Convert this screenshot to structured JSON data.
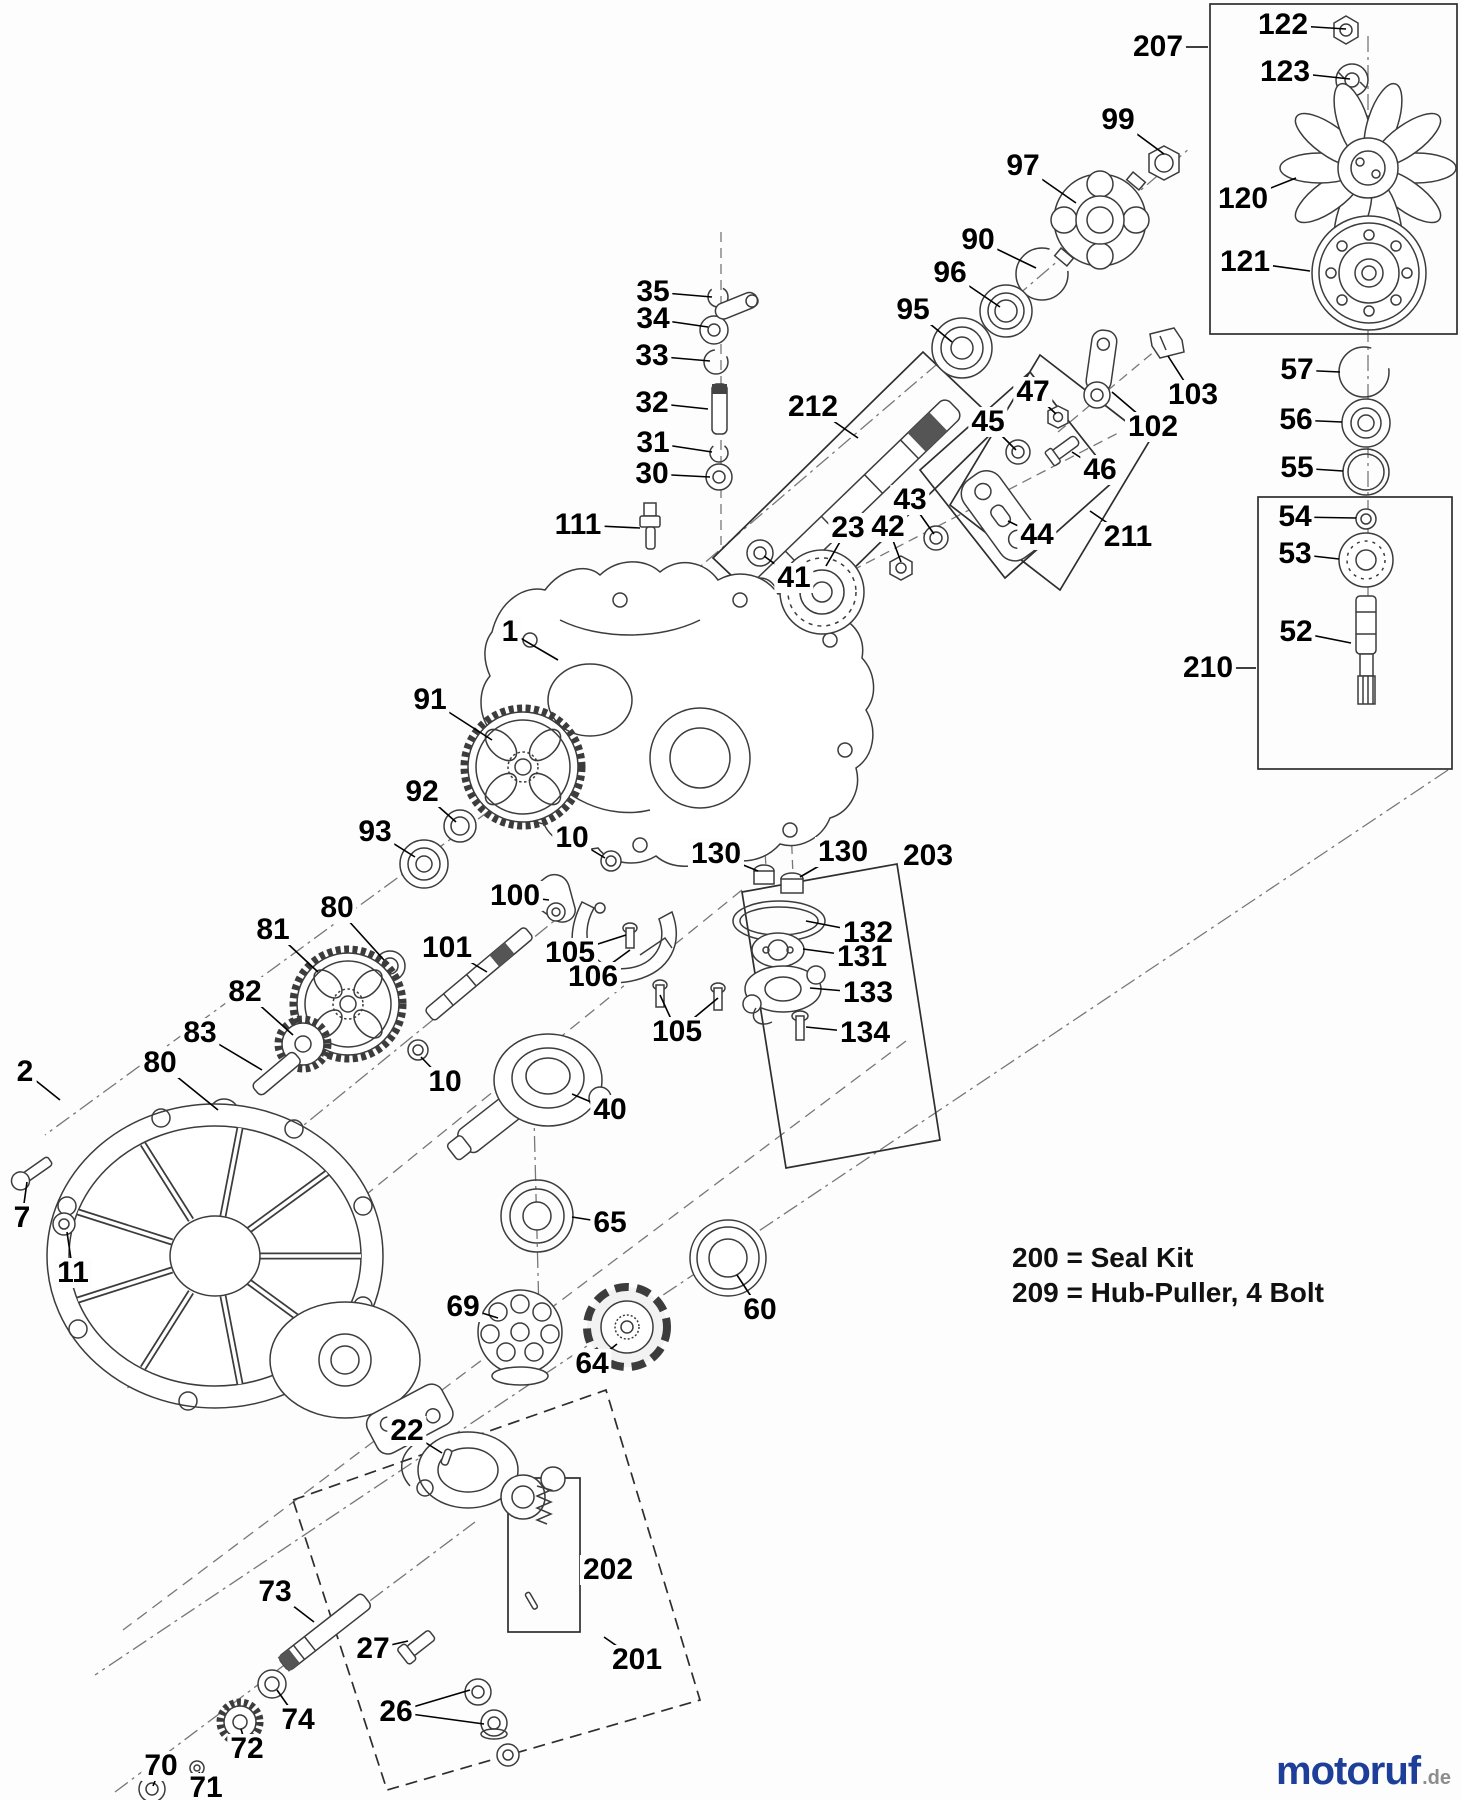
{
  "notes": {
    "line1": "200 = Seal Kit",
    "line2": "209 = Hub-Puller, 4 Bolt"
  },
  "watermark": {
    "brand": "motoruf",
    "tld": ".de",
    "brand_color": "#1e3f99",
    "tld_color": "#8d8d8d"
  },
  "diagram": {
    "title": "Transaxle exploded parts diagram",
    "line_color": "#3c3c3c",
    "label_color": "#000000",
    "callouts": [
      {
        "label": "122",
        "x": 1283,
        "y": 25,
        "targets": [
          [
            1346,
            29
          ]
        ]
      },
      {
        "label": "123",
        "x": 1285,
        "y": 72,
        "targets": [
          [
            1350,
            79
          ]
        ]
      },
      {
        "label": "207",
        "x": 1158,
        "y": 47,
        "targets": [
          [
            1208,
            47
          ]
        ]
      },
      {
        "label": "120",
        "x": 1243,
        "y": 199,
        "targets": [
          [
            1296,
            178
          ]
        ]
      },
      {
        "label": "121",
        "x": 1245,
        "y": 262,
        "targets": [
          [
            1310,
            271
          ]
        ]
      },
      {
        "label": "99",
        "x": 1118,
        "y": 120,
        "targets": [
          [
            1164,
            154
          ]
        ]
      },
      {
        "label": "97",
        "x": 1023,
        "y": 166,
        "targets": [
          [
            1076,
            203
          ]
        ]
      },
      {
        "label": "90",
        "x": 978,
        "y": 240,
        "targets": [
          [
            1036,
            268
          ]
        ]
      },
      {
        "label": "96",
        "x": 950,
        "y": 273,
        "targets": [
          [
            1000,
            307
          ]
        ]
      },
      {
        "label": "95",
        "x": 913,
        "y": 310,
        "targets": [
          [
            952,
            342
          ]
        ]
      },
      {
        "label": "212",
        "x": 813,
        "y": 407,
        "targets": [
          [
            858,
            438
          ]
        ]
      },
      {
        "label": "57",
        "x": 1297,
        "y": 370,
        "targets": [
          [
            1340,
            372
          ]
        ]
      },
      {
        "label": "56",
        "x": 1296,
        "y": 420,
        "targets": [
          [
            1342,
            422
          ]
        ]
      },
      {
        "label": "55",
        "x": 1297,
        "y": 468,
        "targets": [
          [
            1343,
            471
          ]
        ]
      },
      {
        "label": "54",
        "x": 1295,
        "y": 517,
        "targets": [
          [
            1356,
            518
          ]
        ]
      },
      {
        "label": "53",
        "x": 1295,
        "y": 554,
        "targets": [
          [
            1339,
            559
          ]
        ]
      },
      {
        "label": "52",
        "x": 1296,
        "y": 632,
        "targets": [
          [
            1351,
            643
          ]
        ]
      },
      {
        "label": "210",
        "x": 1208,
        "y": 668,
        "targets": [
          [
            1256,
            668
          ]
        ]
      },
      {
        "label": "103",
        "x": 1193,
        "y": 395,
        "targets": [
          [
            1168,
            356
          ]
        ]
      },
      {
        "label": "102",
        "x": 1153,
        "y": 427,
        "targets": [
          [
            1112,
            392
          ]
        ]
      },
      {
        "label": "46",
        "x": 1100,
        "y": 470,
        "targets": [
          [
            1072,
            452
          ]
        ]
      },
      {
        "label": "211",
        "x": 1128,
        "y": 537,
        "targets": [
          [
            1090,
            511
          ]
        ]
      },
      {
        "label": "47",
        "x": 1033,
        "y": 392,
        "targets": [
          [
            1056,
            414
          ]
        ]
      },
      {
        "label": "45",
        "x": 988,
        "y": 422,
        "targets": [
          [
            1016,
            450
          ]
        ]
      },
      {
        "label": "44",
        "x": 1037,
        "y": 535,
        "targets": [
          [
            1008,
            521
          ]
        ]
      },
      {
        "label": "43",
        "x": 910,
        "y": 500,
        "targets": [
          [
            934,
            534
          ]
        ]
      },
      {
        "label": "42",
        "x": 888,
        "y": 527,
        "targets": [
          [
            901,
            562
          ]
        ]
      },
      {
        "label": "23",
        "x": 848,
        "y": 528,
        "targets": [
          [
            826,
            566
          ]
        ]
      },
      {
        "label": "41",
        "x": 794,
        "y": 578,
        "targets": [
          [
            764,
            556
          ]
        ]
      },
      {
        "label": "35",
        "x": 653,
        "y": 292,
        "targets": [
          [
            712,
            297
          ]
        ]
      },
      {
        "label": "34",
        "x": 653,
        "y": 319,
        "targets": [
          [
            708,
            327
          ]
        ]
      },
      {
        "label": "33",
        "x": 652,
        "y": 356,
        "targets": [
          [
            710,
            361
          ]
        ]
      },
      {
        "label": "32",
        "x": 652,
        "y": 403,
        "targets": [
          [
            708,
            409
          ]
        ]
      },
      {
        "label": "31",
        "x": 653,
        "y": 443,
        "targets": [
          [
            712,
            452
          ]
        ]
      },
      {
        "label": "30",
        "x": 652,
        "y": 474,
        "targets": [
          [
            710,
            477
          ]
        ]
      },
      {
        "label": "111",
        "x": 578,
        "y": 525,
        "targets": [
          [
            640,
            528
          ]
        ]
      },
      {
        "label": "1",
        "x": 510,
        "y": 632,
        "targets": [
          [
            558,
            660
          ]
        ]
      },
      {
        "label": "91",
        "x": 430,
        "y": 700,
        "targets": [
          [
            492,
            740
          ]
        ]
      },
      {
        "label": "92",
        "x": 422,
        "y": 792,
        "targets": [
          [
            456,
            822
          ]
        ]
      },
      {
        "label": "93",
        "x": 375,
        "y": 832,
        "targets": [
          [
            415,
            857
          ]
        ]
      },
      {
        "label": "10",
        "x": 572,
        "y": 838,
        "targets": [
          [
            605,
            858
          ]
        ]
      },
      {
        "label": "130",
        "x": 716,
        "y": 854,
        "targets": [
          [
            758,
            871
          ]
        ]
      },
      {
        "label": "130",
        "x": 843,
        "y": 852,
        "targets": [
          [
            800,
            877
          ]
        ]
      },
      {
        "label": "100",
        "x": 515,
        "y": 896,
        "targets": [
          [
            549,
            900
          ]
        ]
      },
      {
        "label": "101",
        "x": 447,
        "y": 948,
        "targets": [
          [
            487,
            972
          ]
        ]
      },
      {
        "label": "105",
        "x": 570,
        "y": 953,
        "targets": [
          [
            626,
            935
          ]
        ]
      },
      {
        "label": "106",
        "x": 593,
        "y": 977,
        "targets": [
          [
            630,
            950
          ]
        ]
      },
      {
        "label": "105",
        "x": 677,
        "y": 1032,
        "targets": [
          [
            660,
            995
          ],
          [
            718,
            998
          ]
        ]
      },
      {
        "label": "132",
        "x": 868,
        "y": 933,
        "targets": [
          [
            806,
            921
          ]
        ]
      },
      {
        "label": "131",
        "x": 862,
        "y": 957,
        "targets": [
          [
            803,
            949
          ]
        ]
      },
      {
        "label": "133",
        "x": 868,
        "y": 993,
        "targets": [
          [
            810,
            988
          ]
        ]
      },
      {
        "label": "134",
        "x": 865,
        "y": 1033,
        "targets": [
          [
            806,
            1027
          ]
        ]
      },
      {
        "label": "203",
        "x": 928,
        "y": 856,
        "targets": [
          [
            903,
            866
          ]
        ]
      },
      {
        "label": "81",
        "x": 273,
        "y": 930,
        "targets": [
          [
            318,
            972
          ]
        ]
      },
      {
        "label": "80",
        "x": 337,
        "y": 908,
        "targets": [
          [
            384,
            960
          ]
        ]
      },
      {
        "label": "82",
        "x": 245,
        "y": 992,
        "targets": [
          [
            293,
            1035
          ]
        ]
      },
      {
        "label": "83",
        "x": 200,
        "y": 1033,
        "targets": [
          [
            262,
            1070
          ]
        ]
      },
      {
        "label": "80",
        "x": 160,
        "y": 1063,
        "targets": [
          [
            218,
            1110
          ]
        ]
      },
      {
        "label": "2",
        "x": 25,
        "y": 1072,
        "targets": [
          [
            60,
            1100
          ]
        ]
      },
      {
        "label": "7",
        "x": 22,
        "y": 1218,
        "targets": [
          [
            27,
            1182
          ]
        ]
      },
      {
        "label": "11",
        "x": 73,
        "y": 1273,
        "targets": [
          [
            67,
            1232
          ]
        ]
      },
      {
        "label": "10",
        "x": 445,
        "y": 1082,
        "targets": [
          [
            421,
            1057
          ]
        ]
      },
      {
        "label": "40",
        "x": 610,
        "y": 1110,
        "targets": [
          [
            572,
            1094
          ]
        ]
      },
      {
        "label": "65",
        "x": 610,
        "y": 1223,
        "targets": [
          [
            572,
            1217
          ]
        ]
      },
      {
        "label": "60",
        "x": 760,
        "y": 1310,
        "targets": [
          [
            737,
            1275
          ]
        ]
      },
      {
        "label": "69",
        "x": 463,
        "y": 1307,
        "targets": [
          [
            498,
            1318
          ]
        ]
      },
      {
        "label": "64",
        "x": 592,
        "y": 1364,
        "targets": [
          [
            617,
            1344
          ]
        ]
      },
      {
        "label": "22",
        "x": 407,
        "y": 1431,
        "targets": [
          [
            442,
            1453
          ]
        ]
      },
      {
        "label": "202",
        "x": 608,
        "y": 1570,
        "targets": [
          [
            581,
            1570
          ]
        ]
      },
      {
        "label": "201",
        "x": 637,
        "y": 1660,
        "targets": [
          [
            604,
            1637
          ]
        ]
      },
      {
        "label": "73",
        "x": 275,
        "y": 1592,
        "targets": [
          [
            314,
            1622
          ]
        ]
      },
      {
        "label": "27",
        "x": 373,
        "y": 1649,
        "targets": [
          [
            408,
            1641
          ]
        ]
      },
      {
        "label": "26",
        "x": 396,
        "y": 1712,
        "targets": [
          [
            470,
            1690
          ],
          [
            484,
            1724
          ]
        ]
      },
      {
        "label": "70",
        "x": 161,
        "y": 1766,
        "targets": [
          [
            153,
            1786
          ]
        ]
      },
      {
        "label": "71",
        "x": 206,
        "y": 1788,
        "targets": [
          [
            199,
            1772
          ]
        ]
      },
      {
        "label": "72",
        "x": 247,
        "y": 1749,
        "targets": [
          [
            241,
            1729
          ]
        ]
      },
      {
        "label": "74",
        "x": 298,
        "y": 1720,
        "targets": [
          [
            277,
            1690
          ]
        ]
      }
    ]
  }
}
